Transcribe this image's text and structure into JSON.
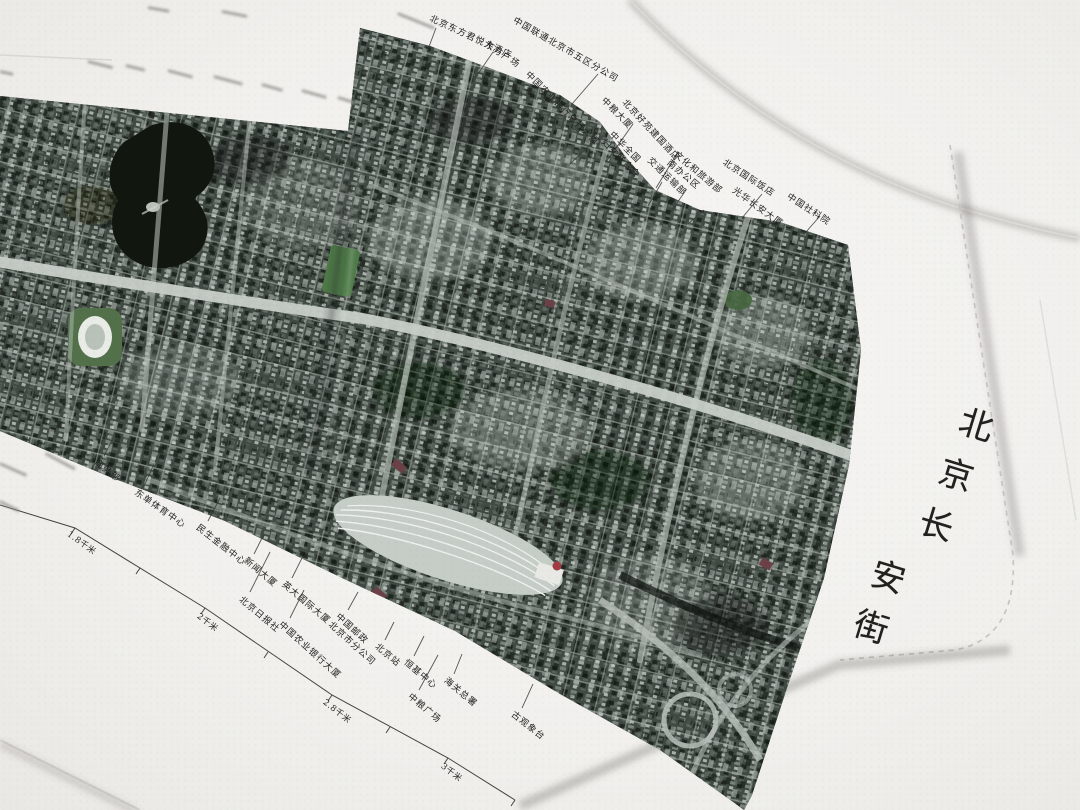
{
  "photo_subject": "accordion-fold printed atlas of satellite imagery, opened on a white table",
  "cover": {
    "title": "北京长安街",
    "title_chars": [
      "北",
      "京",
      "长",
      "安",
      "街"
    ],
    "paper_color": "#eeede9",
    "stitch_color": "#c6c3be"
  },
  "map": {
    "type": "satellite-strip",
    "area": "Beijing Chang'an Avenue, Dongdan to Jianguomen / Beijing Railway Station",
    "base_color": "#3f4942",
    "road_color": "#c6ccc6",
    "water_color": "#11160f",
    "park_color": "#4e7a48",
    "top_labels": [
      {
        "text": "北京东方君悦大酒店"
      },
      {
        "text": "东方广场"
      },
      {
        "text": "中国联通北京市五区分公司"
      },
      {
        "text": "中国农业银行总行大厦"
      },
      {
        "text": "中粮大厦"
      },
      {
        "text": "北京好苑建国酒店"
      },
      {
        "text": "中华全国妇女联合会",
        "lines": [
          "中华全国",
          "妇女联合会"
        ]
      },
      {
        "text": "交通运输部"
      },
      {
        "text": "文化和旅游部南办公区",
        "lines": [
          "文化和旅游部",
          "南办公区"
        ]
      },
      {
        "text": "北京国际饭店"
      },
      {
        "text": "光华长安大厦"
      },
      {
        "text": "中国社科院"
      }
    ],
    "bottom_labels": [
      {
        "text": "商务部"
      },
      {
        "text": "东单体育中心"
      },
      {
        "text": "民生金融中心"
      },
      {
        "text": "新闻大厦"
      },
      {
        "text": "北京日报社"
      },
      {
        "text": "英大国际大厦"
      },
      {
        "text": "中国农业银行大厦"
      },
      {
        "text": "中国邮政北京市分公司",
        "lines": [
          "中国邮政",
          "北京市分公司"
        ]
      },
      {
        "text": "北京站"
      },
      {
        "text": "恒基中心"
      },
      {
        "text": "海关总署"
      },
      {
        "text": "中粮广场"
      },
      {
        "text": "古观象台"
      }
    ],
    "scale_marks": [
      "1.8千米",
      "2千米",
      "2.8千米",
      "3千米"
    ]
  }
}
